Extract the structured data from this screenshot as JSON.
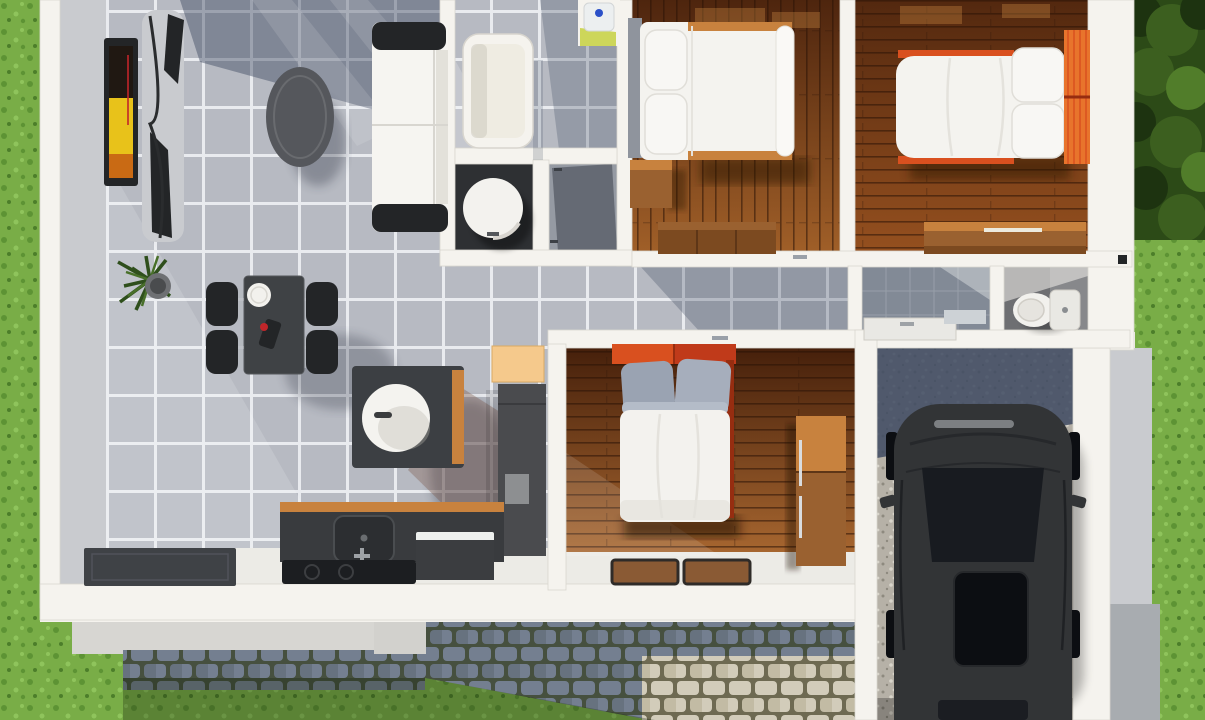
{
  "scene": {
    "type": "3d-floor-plan-render",
    "description": "Top-down 3D architectural render of a small single-storey house with open living/dining/kitchen, bathroom, three bedrooms, WC and a garage with parked car, surrounded by lawn and cobblestone path",
    "rooms": [
      {
        "name": "living-room",
        "floor": "grey-tile",
        "furniture": [
          "wall-tv",
          "tv-cabinet",
          "coffee-table",
          "sofa",
          "potted-plant"
        ]
      },
      {
        "name": "dining-area",
        "floor": "grey-tile",
        "furniture": [
          "dining-table",
          "dining-chairs-x4",
          "plate",
          "table-decor"
        ]
      },
      {
        "name": "kitchen",
        "floor": "grey-tile",
        "furniture": [
          "kitchen-island",
          "island-basin",
          "orange-cabinet",
          "pantry-unit",
          "counter-with-sink",
          "appliance",
          "cooktop",
          "door-mat"
        ]
      },
      {
        "name": "bathroom",
        "floor": "grey-tile",
        "furniture": [
          "bathtub",
          "washbasin",
          "shower-cylinder",
          "closet"
        ]
      },
      {
        "name": "hallway",
        "floor": "grey-tile",
        "furniture": []
      },
      {
        "name": "bedroom-top-center",
        "floor": "dark-wood",
        "furniture": [
          "double-bed-white",
          "pillows-x2",
          "nightstand",
          "dresser"
        ]
      },
      {
        "name": "bedroom-top-right",
        "floor": "dark-wood",
        "furniture": [
          "double-bed-orange",
          "pillows-x2",
          "desk"
        ]
      },
      {
        "name": "bedroom-bottom",
        "floor": "dark-wood",
        "furniture": [
          "double-bed-red",
          "grey-pillows-x2",
          "wardrobe",
          "rugs-x2"
        ]
      },
      {
        "name": "utility-bath",
        "floor": "grey-tile",
        "furniture": [
          "counter"
        ]
      },
      {
        "name": "wc",
        "floor": "dark-tile",
        "furniture": [
          "toilet"
        ]
      },
      {
        "name": "garage",
        "floor": "gravel",
        "furniture": [
          "car"
        ]
      }
    ],
    "exterior": [
      "grass-lawn",
      "hedge",
      "cobblestone-path-shadow",
      "cobblestone-path-light",
      "gravel-driveway",
      "porch-step",
      "foundation"
    ]
  },
  "palette": {
    "grass_base": "#79ad47",
    "grass_dark": "#5d9334",
    "grass_light": "#8fc45c",
    "grass_deep": "#4c7e2a",
    "hedge_base": "#2c4a17",
    "hedge_dark": "#1d3310",
    "hedge_mid": "#3c5f1f",
    "hedge_light": "#517d2a",
    "wall_white": "#f5f3ee",
    "wall_edge": "#d9d6cf",
    "wall_face": "#c9cbcf",
    "foundation": "#d7d6d2",
    "step": "#d2d1cd",
    "gray_deep": "#a8acb0",
    "tile_base": "#b7bac2",
    "tile_grout": "#e9ebef",
    "shadow_blue": "#3e4a61",
    "shadow_warm": "#7a5548",
    "white_floor": "#ecebe6",
    "wood1_a": "#4e250e",
    "wood1_b": "#a05f28",
    "wood2_a": "#53280f",
    "wood2_b": "#95501f",
    "wood3_a": "#46200b",
    "wood3_b": "#a86730",
    "wood_furn": "#9a6130",
    "wood_furn_light": "#c8823e",
    "wood_furn_dark": "#7c4a20",
    "counter_dark": "#393b3e",
    "furn_dark": "#3f4245",
    "furn_black": "#232527",
    "gray_box": "#8d8f91",
    "sofa_white": "#f6f5f1",
    "pillow_gray": "#9aa3b2",
    "pillow_gray2": "#a6aebc",
    "orange": "#e8742c",
    "orange_deep": "#d9501f",
    "red_head": "#c03a1a",
    "red_dark": "#962d10",
    "peach": "#f5c98c",
    "lime": "#cdd65a",
    "blue_dot": "#2b50c8",
    "mat_dark": "#3f4246",
    "cook_black": "#1c1e21",
    "tub_inner": "#efece2",
    "wc_floor": "#6e6f72",
    "bathA_floor": "#828a96",
    "closet_gray": "#959aa3",
    "shower_dark": "#2e3033",
    "cobble_moss": "#46503f",
    "cobble_stone": "#747f90",
    "cobble_stone2": "#67727f",
    "sand_bg": "#6e6a52",
    "sand_stone": "#d2ccba",
    "sand_stone2": "#c2bba4",
    "gravel_bg": "#b6b1a7",
    "gravel_d1": "#8e8a7f",
    "gravel_d2": "#d8d4ca",
    "car_body": "#323436",
    "car_mid": "#26282b",
    "car_glass": "#181b20",
    "car_black": "#0c0e12",
    "car_trim": "#8f9296",
    "tv_yellow": "#e8c21a",
    "tv_orange": "#c96a14",
    "tv_dark": "#201812",
    "tv_red": "#c0262a",
    "plant_green": "#2f4f1c",
    "plant_green2": "#49702a",
    "pot_gray": "#6e7073",
    "metal": "#b6bac0",
    "sun_patch": "#e09a4d",
    "white_obj": "#f2f1ed"
  }
}
